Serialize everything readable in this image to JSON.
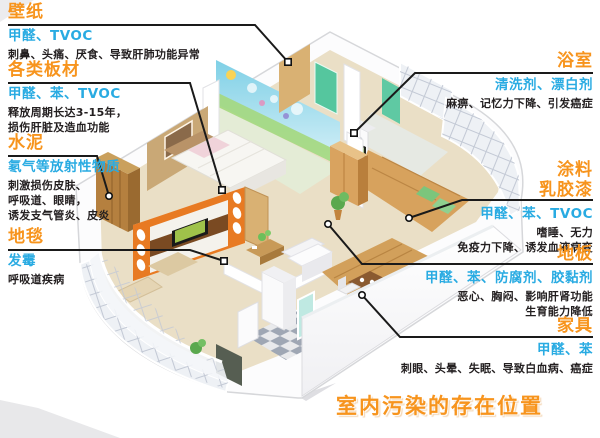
{
  "title": "室内污染的存在位置",
  "colors": {
    "heading": "#F7941D",
    "pollutant": "#29ABE2",
    "symptom": "#231F20",
    "callout_line": "#1A1A1A"
  },
  "callouts": {
    "wallpaper": {
      "heading": "壁纸",
      "pollutants": "甲醛、TVOC",
      "symptom1": "刺鼻、头痛、厌食、导致肝肺功能异常"
    },
    "boards": {
      "heading": "各类板材",
      "pollutants": "甲醛、苯、TVOC",
      "symptom1": "释放周期长达3-15年，",
      "symptom2": "损伤肝脏及造血功能"
    },
    "cement": {
      "heading": "水泥",
      "pollutants": "氡气等放射性物质",
      "symptom1": "刺激损伤皮肤、",
      "symptom2": "呼吸道、眼睛，",
      "symptom3": "诱发支气管炎、皮炎"
    },
    "carpet": {
      "heading": "地毯",
      "pollutants": "发霉",
      "symptom1": "呼吸道疾病"
    },
    "bathroom": {
      "heading": "浴室",
      "pollutants": "清洗剂、漂白剂",
      "symptom1": "麻痹、记忆力下降、引发癌症"
    },
    "paint": {
      "heading": "涂料",
      "heading2": "乳胶漆",
      "pollutants": "甲醛、苯、TVOC",
      "symptom1": "嗜睡、无力",
      "symptom2": "免疫力下降、诱发血液病变"
    },
    "floor": {
      "heading": "地板",
      "pollutants": "甲醛、苯、防腐剂、胶黏剂",
      "symptom1": "恶心、胸闷、影响肝肾功能",
      "symptom2": "生育能力降低"
    },
    "furniture": {
      "heading": "家具",
      "pollutants": "甲醛、苯",
      "symptom1": "刺眼、头晕、失眠、导致白血病、癌症"
    }
  }
}
